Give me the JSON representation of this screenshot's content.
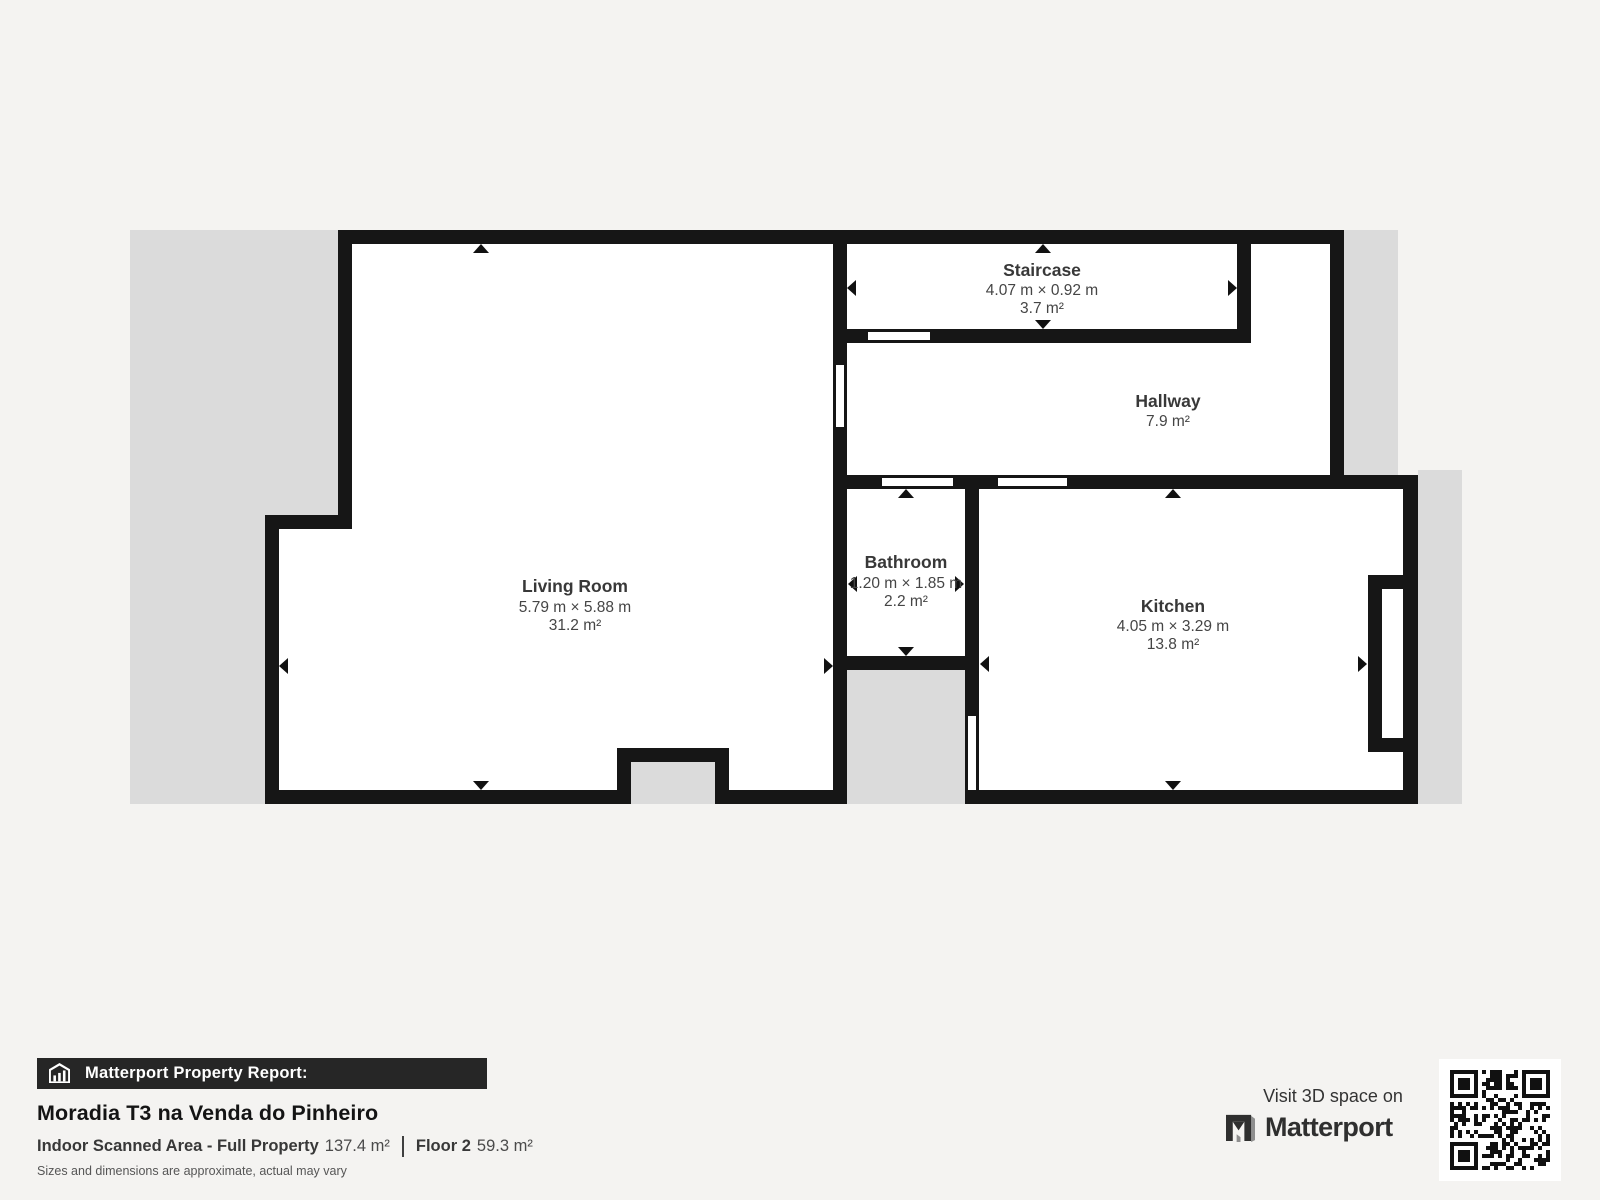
{
  "floorplan": {
    "rooms": {
      "staircase": {
        "name": "Staircase",
        "dims": "4.07 m × 0.92 m",
        "area": "3.7 m²"
      },
      "hallway": {
        "name": "Hallway",
        "area": "7.9 m²"
      },
      "living_room": {
        "name": "Living Room",
        "dims": "5.79 m × 5.88 m",
        "area": "31.2 m²"
      },
      "bathroom": {
        "name": "Bathroom",
        "dims": "1.20 m × 1.85 m",
        "area": "2.2 m²"
      },
      "kitchen": {
        "name": "Kitchen",
        "dims": "4.05 m × 3.29 m",
        "area": "13.8 m²"
      }
    }
  },
  "report": {
    "banner_label": "Matterport Property Report:",
    "property_name": "Moradia T3 na Venda do Pinheiro",
    "scanned_area_label": "Indoor Scanned Area - Full Property",
    "scanned_area_value": "137.4 m²",
    "floor_label": "Floor 2",
    "floor_value": "59.3 m²",
    "disclaimer": "Sizes and dimensions are approximate, actual may vary"
  },
  "promo": {
    "visit_text": "Visit 3D space on",
    "brand": "Matterport"
  },
  "colors": {
    "background": "#f4f3f1",
    "exterior": "#dbdbdb",
    "wall": "#161616",
    "room": "#ffffff",
    "banner-bg": "#262626",
    "logo-color": "#2f2f2f"
  }
}
